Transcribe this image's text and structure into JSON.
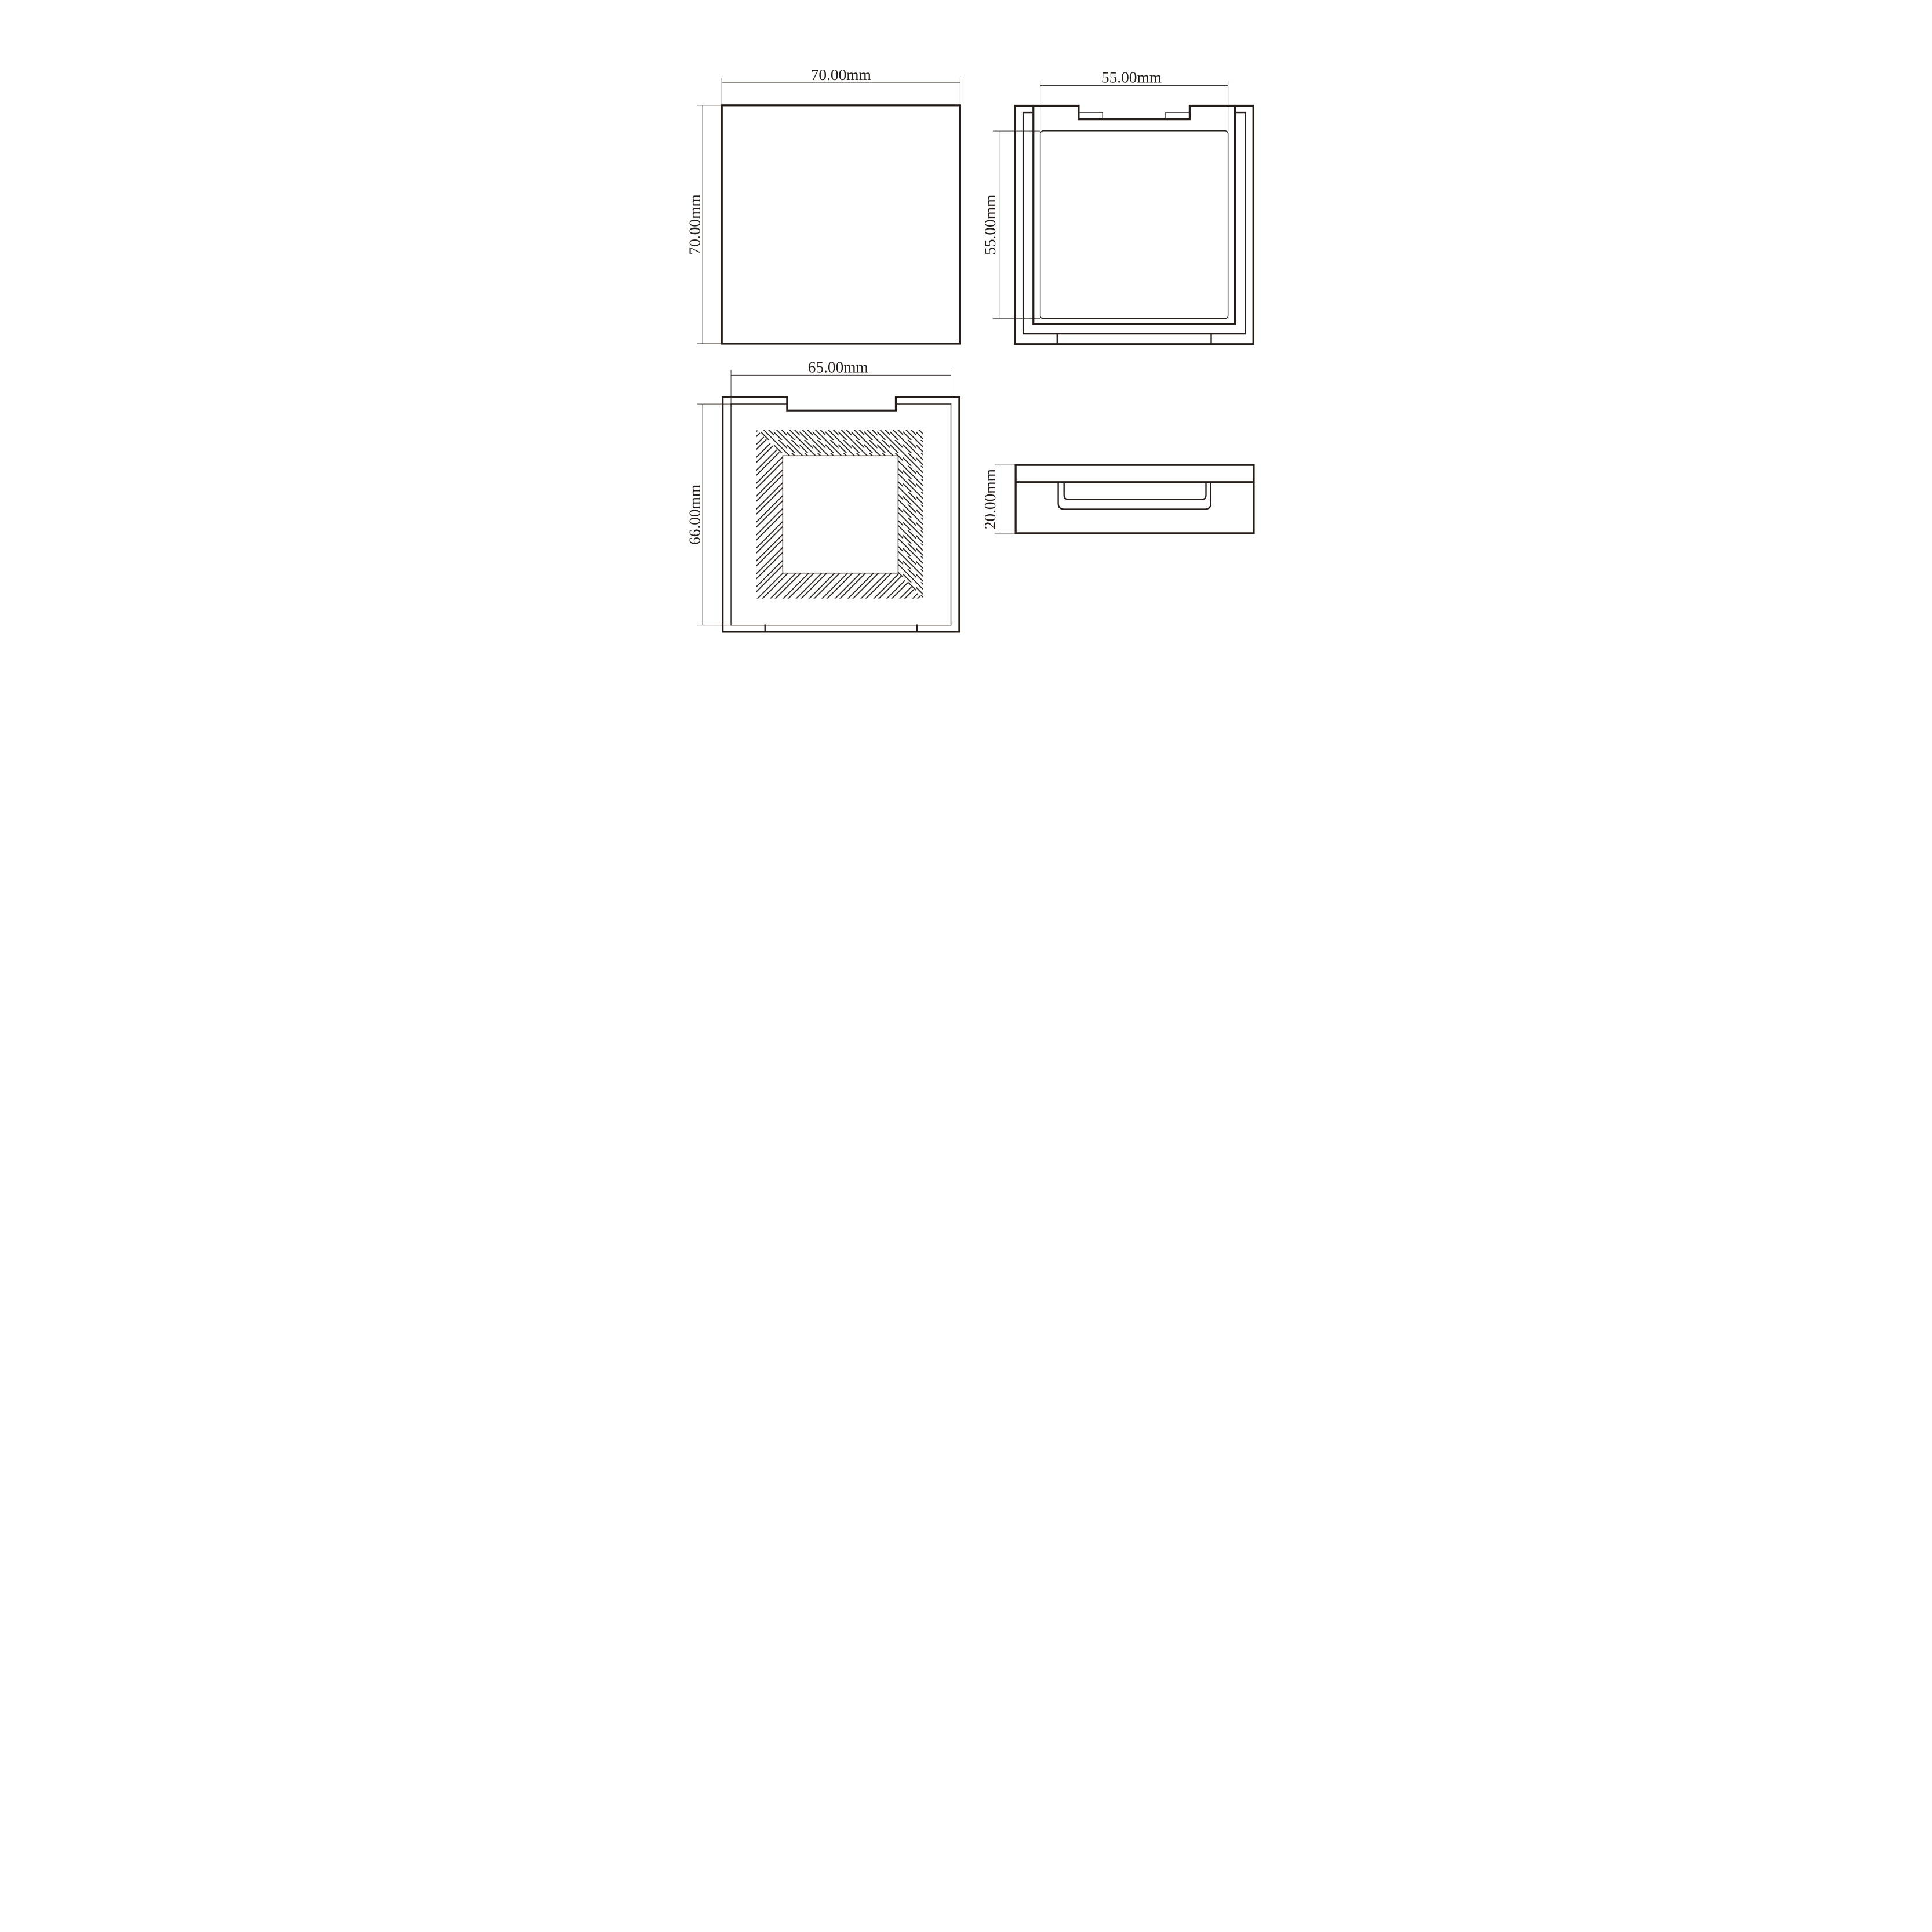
{
  "colors": {
    "ink": "#241c18",
    "background": "#ffffff"
  },
  "units": "mm",
  "views": {
    "front": {
      "position": "top-left",
      "label_width": "70.00mm",
      "label_height": "70.00mm"
    },
    "inner": {
      "position": "top-right",
      "label_width": "55.00mm",
      "label_height": "55.00mm"
    },
    "back": {
      "position": "bottom-left",
      "label_width": "65.00mm",
      "label_height": "66.00mm"
    },
    "side": {
      "position": "bottom-right",
      "label_thickness": "20.00mm"
    }
  }
}
